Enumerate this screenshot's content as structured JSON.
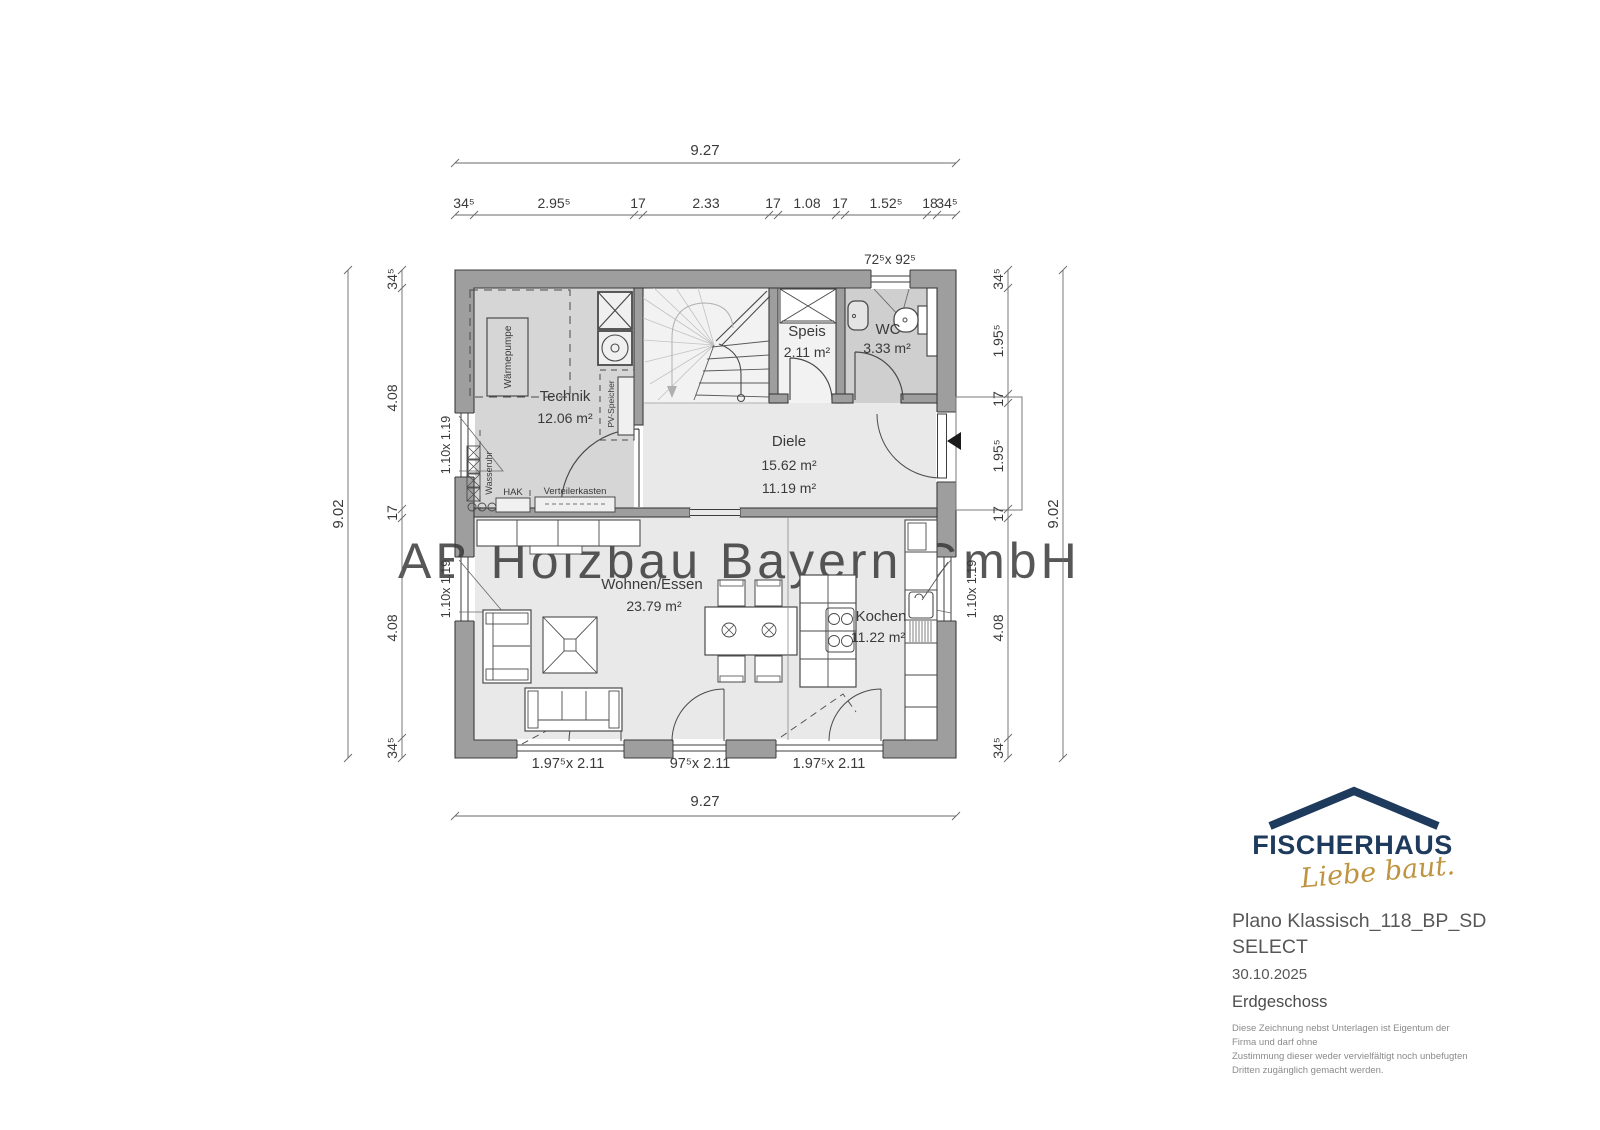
{
  "watermark": "AB Holzbau Bayern GmbH",
  "rooms": {
    "technik": {
      "name": "Technik",
      "area": "12.06 m²"
    },
    "speis": {
      "name": "Speis",
      "area": "2.11 m²"
    },
    "wc": {
      "name": "WC",
      "area": "3.33 m²"
    },
    "diele": {
      "name": "Diele",
      "area1": "15.62 m²",
      "area2": "11.19 m²"
    },
    "wohnen": {
      "name": "Wohnen/Essen",
      "area": "23.79 m²"
    },
    "kochen": {
      "name": "Kochen",
      "area": "11.22 m²"
    }
  },
  "equipment": {
    "waermepumpe": "Wärmepumpe",
    "pv_speicher": "PV-Speicher",
    "wasseruhr": "Wasseruhr",
    "hak": "HAK",
    "verteilerkasten": "Verteilerkasten"
  },
  "dims": {
    "top_total": "9.27",
    "bottom_total": "9.27",
    "left_total": "9.02",
    "right_total": "9.02",
    "top_chain": [
      "34⁵",
      "2.95⁵",
      "17",
      "2.33",
      "17",
      "1.08",
      "17",
      "1.52⁵",
      "18",
      "34⁵"
    ],
    "left_chain": [
      "34⁵",
      "4.08",
      "17",
      "4.08",
      "34⁵"
    ],
    "right_chain": [
      "34⁵",
      "1.95⁵",
      "17",
      "1.95⁵",
      "17",
      "4.08",
      "34⁵"
    ],
    "wc_window": "72⁵x 92⁵",
    "window_left_top": "1.10x 1.19",
    "window_left_bottom": "1.10x 1.19",
    "window_right": "1.10x 1.19",
    "door_bottom_left": "1.97⁵x 2.11",
    "door_bottom_middle": "97⁵x 2.11",
    "door_bottom_right": "1.97⁵x 2.11"
  },
  "title_block": {
    "brand": "FISCHERHAUS",
    "slogan": "Liebe baut.",
    "title_line1": "Plano Klassisch_118_BP_SD",
    "title_line2": "SELECT",
    "date": "30.10.2025",
    "floor": "Erdgeschoss",
    "disclaimer_lines": [
      "Diese Zeichnung nebst Unterlagen ist Eigentum der",
      "Firma  und darf ohne",
      "Zustimmung dieser weder vervielfältigt noch unbefugten",
      "Dritten zugänglich gemacht werden."
    ]
  },
  "colors": {
    "brand_navy": "#1e3a5c",
    "brand_gold": "#bf9440",
    "wall_gray": "#9e9e9e",
    "floor_light": "#e9e9e9",
    "floor_mid": "#d6d6d6"
  }
}
